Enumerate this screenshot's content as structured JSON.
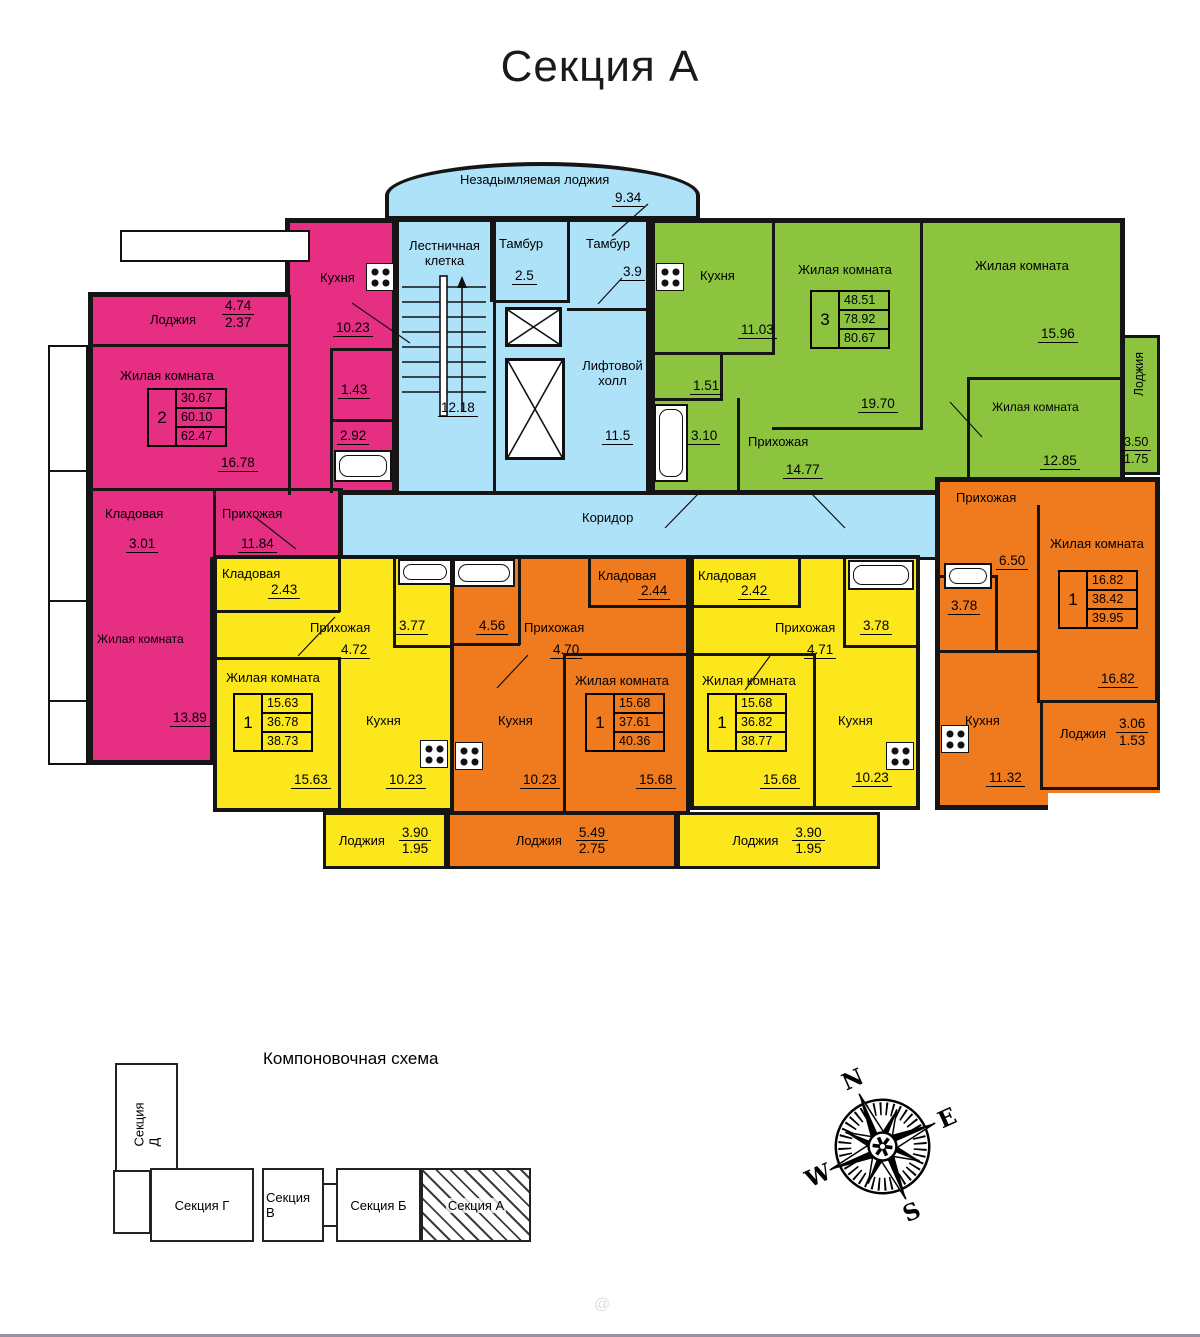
{
  "title": "Секция А",
  "colors": {
    "pink": "#e62e83",
    "green": "#8cc43f",
    "yellow": "#fbe71c",
    "orange": "#ef7b1e",
    "blue": "#aee2f8"
  },
  "common": {
    "loggia_top": {
      "label": "Незадымляемая лоджия",
      "area": "9.34"
    },
    "stairs": {
      "label": "Лестничная клетка",
      "area": "12.18"
    },
    "tambour_left": {
      "label": "Тамбур",
      "area": "2.5"
    },
    "tambour_right": {
      "label": "Тамбур",
      "area": "3.9"
    },
    "lift_hall": {
      "label": "Лифтовой холл",
      "area": "11.5"
    },
    "corridor": {
      "label": "Коридор"
    }
  },
  "apt_pink": {
    "stamp": {
      "rooms": "2",
      "living": "30.67",
      "area": "60.10",
      "total": "62.47"
    },
    "loggia": {
      "label": "Лоджия",
      "num": "4.74",
      "den": "2.37"
    },
    "kitchen": {
      "label": "Кухня",
      "area": "10.23"
    },
    "living1": {
      "label": "Жилая комната",
      "area": "16.78"
    },
    "wc": {
      "area": "1.43"
    },
    "bath": {
      "area": "2.92"
    },
    "storage": {
      "label": "Кладовая",
      "area": "3.01"
    },
    "hall": {
      "label": "Прихожая",
      "area": "11.84"
    },
    "living2": {
      "label": "Жилая комната",
      "area": "13.89"
    }
  },
  "apt_green": {
    "stamp": {
      "rooms": "3",
      "living": "48.51",
      "area": "78.92",
      "total": "80.67"
    },
    "kitchen": {
      "label": "Кухня",
      "area": "11.03"
    },
    "living1": {
      "label": "Жилая комната",
      "area": "19.70"
    },
    "living2": {
      "label": "Жилая комната",
      "area": "15.96"
    },
    "living3": {
      "label": "Жилая комната",
      "area": "12.85"
    },
    "wc": {
      "area": "1.51"
    },
    "bath": {
      "area": "3.10"
    },
    "hall": {
      "label": "Прихожая",
      "area": "14.77"
    },
    "loggia": {
      "label": "Лоджия",
      "num": "3.50",
      "den": "1.75"
    }
  },
  "apt_yellow_left": {
    "stamp": {
      "rooms": "1",
      "living": "15.63",
      "area": "36.78",
      "total": "38.73"
    },
    "storage": {
      "label": "Кладовая",
      "area": "2.43"
    },
    "hall": {
      "label": "Прихожая",
      "area": "4.72"
    },
    "bath": {
      "area": "3.77"
    },
    "living": {
      "label": "Жилая комната",
      "area": "15.63"
    },
    "kitchen": {
      "label": "Кухня",
      "area": "10.23"
    },
    "loggia": {
      "label": "Лоджия",
      "num": "3.90",
      "den": "1.95"
    }
  },
  "apt_orange_mid": {
    "stamp": {
      "rooms": "1",
      "living": "15.68",
      "area": "37.61",
      "total": "40.36"
    },
    "bath": {
      "area": "4.56"
    },
    "hall": {
      "label": "Прихожая",
      "area": "4.70"
    },
    "storage": {
      "label": "Кладовая",
      "area": "2.44"
    },
    "living": {
      "label": "Жилая комната",
      "area": "15.68"
    },
    "kitchen": {
      "label": "Кухня",
      "area": "10.23"
    },
    "loggia": {
      "label": "Лоджия",
      "num": "5.49",
      "den": "2.75"
    }
  },
  "apt_yellow_right": {
    "stamp": {
      "rooms": "1",
      "living": "15.68",
      "area": "36.82",
      "total": "38.77"
    },
    "storage": {
      "label": "Кладовая",
      "area": "2.42"
    },
    "hall": {
      "label": "Прихожая",
      "area": "4.71"
    },
    "bath": {
      "area": "3.78"
    },
    "living": {
      "label": "Жилая комната",
      "area": "15.68"
    },
    "kitchen": {
      "label": "Кухня",
      "area": "10.23"
    },
    "loggia": {
      "label": "Лоджия",
      "num": "3.90",
      "den": "1.95"
    }
  },
  "apt_orange_right": {
    "stamp": {
      "rooms": "1",
      "living": "16.82",
      "area": "38.42",
      "total": "39.95"
    },
    "hall": {
      "label": "Прихожая",
      "area": "6.50"
    },
    "living": {
      "label": "Жилая комната",
      "area": "16.82"
    },
    "bath": {
      "area": "3.78"
    },
    "kitchen": {
      "label": "Кухня",
      "area": "11.32"
    },
    "loggia": {
      "label": "Лоджия",
      "num": "3.06",
      "den": "1.53"
    }
  },
  "scheme": {
    "title": "Компоновочная схема",
    "sections": [
      {
        "label": "Секция Д"
      },
      {
        "label": "Секция Г"
      },
      {
        "label": "Секция В"
      },
      {
        "label": "Секция Б"
      },
      {
        "label": "Секция А"
      }
    ]
  },
  "compass": {
    "n": "N",
    "e": "E",
    "s": "S",
    "w": "W"
  },
  "watermark": "@"
}
